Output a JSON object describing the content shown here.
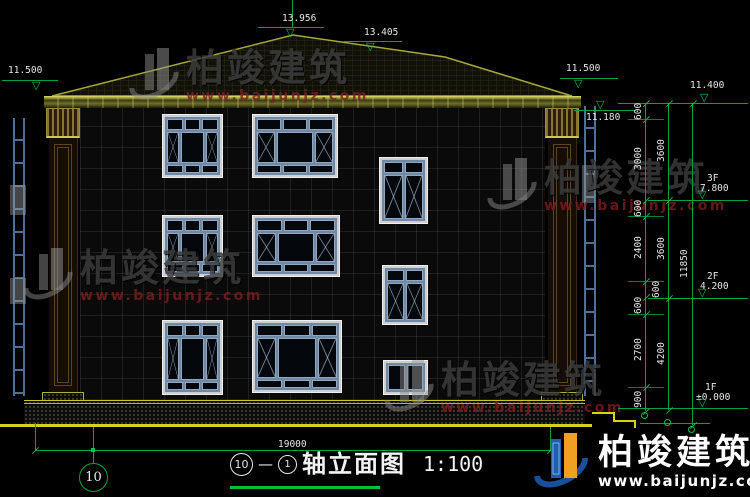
{
  "watermark": {
    "name": "柏竣建筑",
    "url": "www.baijunjz.com"
  },
  "elevations": {
    "ridge_main": "13.956",
    "ridge_secondary": "13.405",
    "eave_left": "11.500",
    "eave_right": "11.500",
    "cornice_right": "11.180",
    "roof_eave_level": "11.400"
  },
  "levels": [
    {
      "floor": "3F",
      "value": "7.800"
    },
    {
      "floor": "2F",
      "value": "4.200"
    },
    {
      "floor": "1F",
      "value": "±0.000"
    }
  ],
  "dimensions": {
    "chain_a": [
      "600",
      "3000",
      "600",
      "2400",
      "600",
      "600",
      "2700",
      "900"
    ],
    "chain_b": [
      "3600",
      "3600",
      "4200"
    ],
    "overall_height": "11850",
    "overall_width": "19000"
  },
  "axis": {
    "bubble_left": "10"
  },
  "title": {
    "axis_start": "10",
    "dash": "—",
    "axis_end": "1",
    "name": "轴立面图",
    "scale": "1:100"
  }
}
